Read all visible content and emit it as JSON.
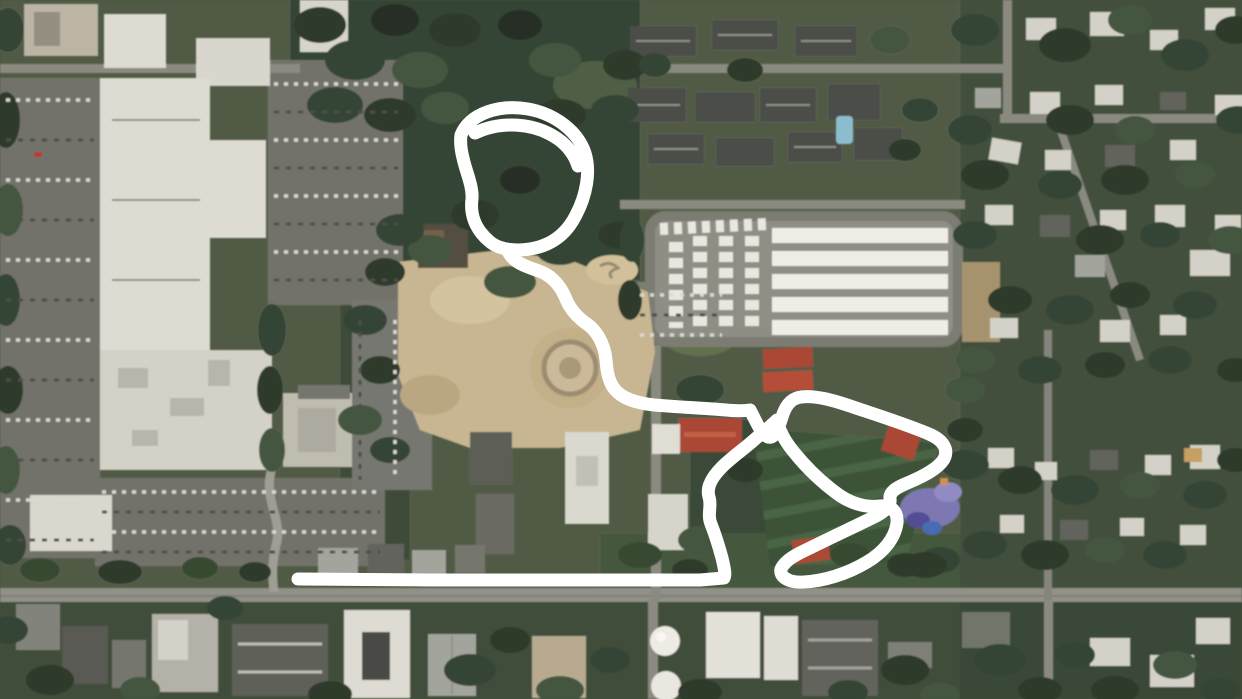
{
  "canvas": {
    "width": 1242,
    "height": 699
  },
  "palette": {
    "ground": "#47523b",
    "canopy_dark": "#22301f",
    "canopy": "#2c3c2a",
    "canopy_light": "#3c4e35",
    "field_green": "#33492f",
    "field_stripe": "#415d3a",
    "parking_gray": "#6b6b64",
    "road_gray": "#8d8c82",
    "building_white": "#dcdad0",
    "storage_roof_white": "#f0ede5",
    "tan_dirt": "#c6b28c",
    "red_roof": "#a63d2a",
    "pool_blue": "#86bacc",
    "playground_purple": "#7671ad",
    "annotation_white": "#ffffff"
  },
  "annotation": {
    "color": "#ffffff",
    "stroke_width": 13,
    "path": "M461 135 C470 113 500 104 528 109 C556 114 578 132 585 153 C591 172 586 196 576 215 C568 231 556 242 539 247 C521 252 500 251 489 241 C475 229 470 214 472 199 C473 186 466 172 463 158 C461 150 460 142 461 135 M475 133 C500 121 534 122 558 139 C568 146 575 156 578 166 M507 249 C512 262 524 266 539 271 C553 276 561 287 566 299 C570 309 577 317 587 324 C597 331 602 341 605 353 C607 364 606 376 613 387 C621 399 637 403 654 405 C678 407 702 408 726 410 C736 411 744 411 750 410 C757 423 761 434 768 437 C775 439 779 427 783 414 C787 403 793 398 801 397 C815 395 833 400 856 408 C880 416 908 425 929 434 C943 440 949 449 944 459 C938 469 922 477 905 484 C896 488 889 492 890 499 C891 505 886 511 876 516 C856 526 832 537 810 548 C797 554 785 560 781 569 C779 577 789 583 804 582 C824 581 847 574 867 562 C884 552 895 538 897 523 C898 512 892 505 880 506 C865 508 849 503 835 492 C819 480 805 466 793 451 C785 441 779 430 777 420 C771 426 763 432 754 440 C744 449 732 457 722 467 C713 476 706 487 709 497 C712 506 707 514 711 524 C715 534 719 547 722 558 C724 567 726 574 724 578 L700 580 L560 580 L430 580 L298 579"
  }
}
